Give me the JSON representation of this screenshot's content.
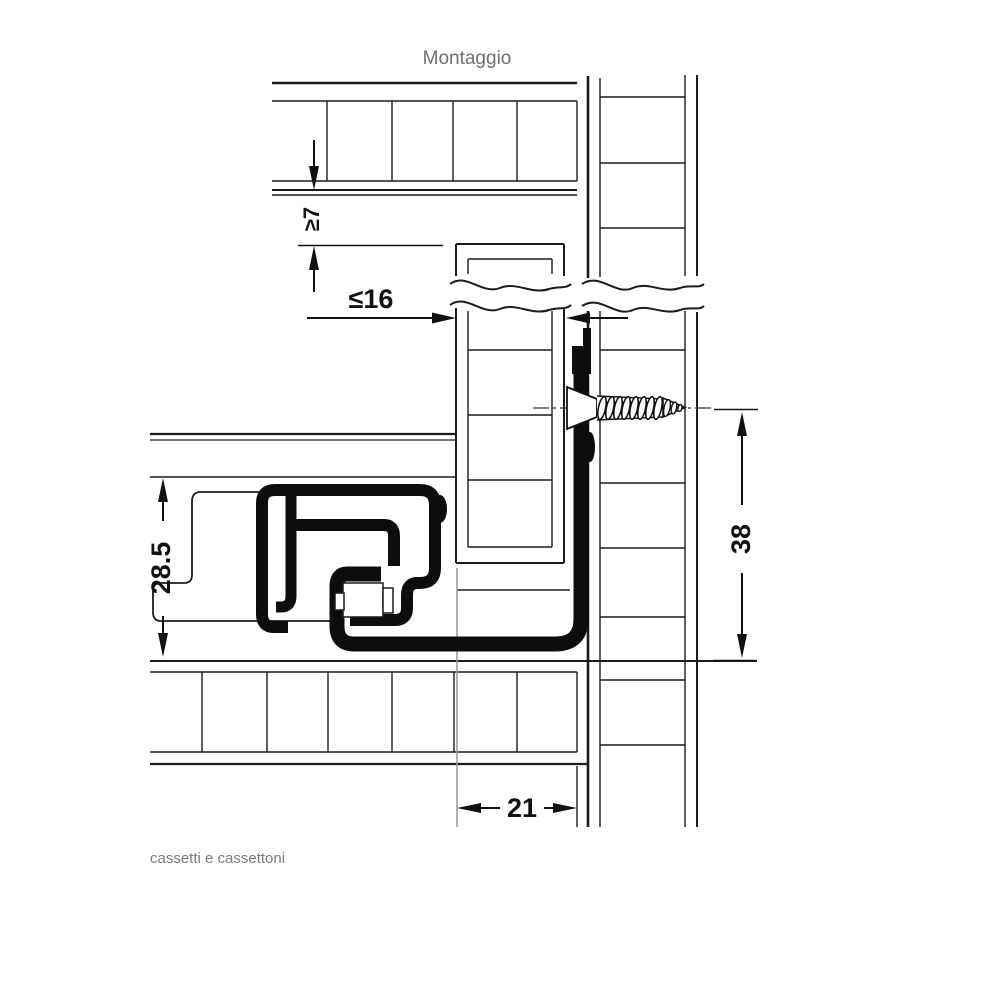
{
  "title": "Montaggio",
  "caption": "cassetti e cassettoni",
  "diagram": {
    "type": "technical-cross-section",
    "subject": "drawer slide mounting on cabinet side panel",
    "dimensions": {
      "top_clearance": "≥7",
      "front_panel_thickness": "≤16",
      "runner_profile_height": "28.5",
      "screw_axis_height": "38",
      "bottom_inset": "21"
    },
    "colors": {
      "line": "#1c1c1c",
      "profile_fill": "#0d0d0d",
      "label": "#111111",
      "muted_text": "#757575",
      "extension_line": "#999999",
      "background": "#ffffff"
    }
  }
}
